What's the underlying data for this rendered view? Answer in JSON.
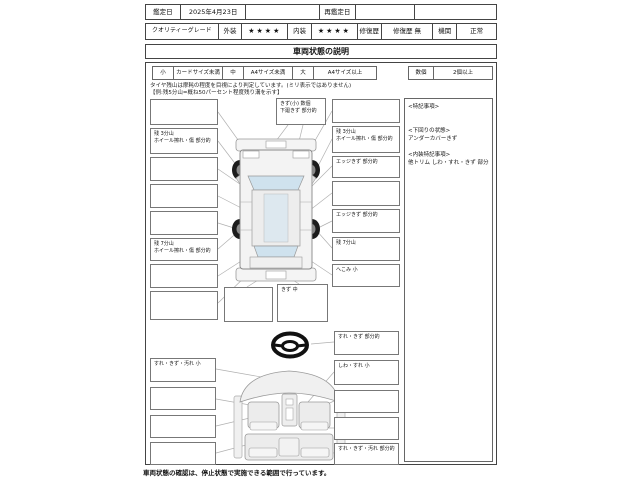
{
  "header": {
    "appraisal_date_label": "鑑定日",
    "appraisal_date_value": "2025年4月23日",
    "re_appraisal_label": "再鑑定日",
    "quality_grade_label": "クオリティーグレード",
    "exterior_label": "外装",
    "exterior_rating": "★★★★",
    "interior_label": "内装",
    "interior_rating": "★★★★",
    "repair_history_label": "修復歴",
    "repair_history_value": "修復歴 無",
    "engine_label": "機関",
    "engine_value": "正常"
  },
  "section_title": "車両状態の説明",
  "size_legend": {
    "small_key": "小",
    "small_value": "カードサイズ未満",
    "medium_key": "中",
    "medium_value": "A4サイズ未満",
    "large_key": "大",
    "large_value": "A4サイズ以上",
    "count_key": "数個",
    "count_value": "2個以上"
  },
  "tire_note_line1": "タイヤ残山は摩耗の程度を目視により判定しています。(ミリ表示ではありません)",
  "tire_note_line2": "【例:残5分山=概ね50パーセント程度残り溝を示す】",
  "exterior_diagram": {
    "top_label": {
      "l1": "きず(小) 数個",
      "l2": "下廻きず 部分的"
    },
    "left_labels": [
      {
        "l1": "",
        "l2": ""
      },
      {
        "l1": "残 3分山",
        "l2": "ホイール擦れ・傷 部分的"
      },
      {
        "l1": "",
        "l2": ""
      },
      {
        "l1": "",
        "l2": ""
      },
      {
        "l1": "",
        "l2": ""
      },
      {
        "l1": "残 7分山",
        "l2": "ホイール擦れ・傷 部分的"
      },
      {
        "l1": "",
        "l2": ""
      },
      {
        "l1": "",
        "l2": ""
      }
    ],
    "right_labels": [
      {
        "l1": "",
        "l2": ""
      },
      {
        "l1": "残 3分山",
        "l2": "ホイール擦れ・傷 部分的"
      },
      {
        "l1": "エッジきず 部分的",
        "l2": ""
      },
      {
        "l1": "",
        "l2": ""
      },
      {
        "l1": "エッジきず 部分的",
        "l2": ""
      },
      {
        "l1": "残 7分山",
        "l2": ""
      },
      {
        "l1": "へこみ 小",
        "l2": ""
      }
    ],
    "bottom_center_label": {
      "l1": "",
      "l2": ""
    },
    "bottom_right_label": {
      "l1": "きず 中",
      "l2": ""
    }
  },
  "interior_diagram": {
    "left_labels": [
      {
        "l1": "すれ・きず・汚れ 小"
      },
      {
        "l1": ""
      },
      {
        "l1": ""
      },
      {
        "l1": ""
      }
    ],
    "right_labels": [
      {
        "l1": "すれ・きず 部分的"
      },
      {
        "l1": "しわ・すれ 小"
      },
      {
        "l1": ""
      },
      {
        "l1": ""
      },
      {
        "l1": "すれ・きず・汚れ 部分的"
      }
    ]
  },
  "special_notes": {
    "title": "<特記事項>",
    "underbody_heading": "<下回りの状態>",
    "underbody_text": "アンダーカバーきず",
    "interior_heading": "<内装特記事項>",
    "interior_text": "他トリム しわ・すれ・きず 部分的"
  },
  "footer_note": "車両状態の確認は、停止状態で実施できる範囲で行っています。",
  "colors": {
    "glass": "#cfe2ee",
    "body_fill": "#f3f3f3",
    "border": "#444444"
  }
}
